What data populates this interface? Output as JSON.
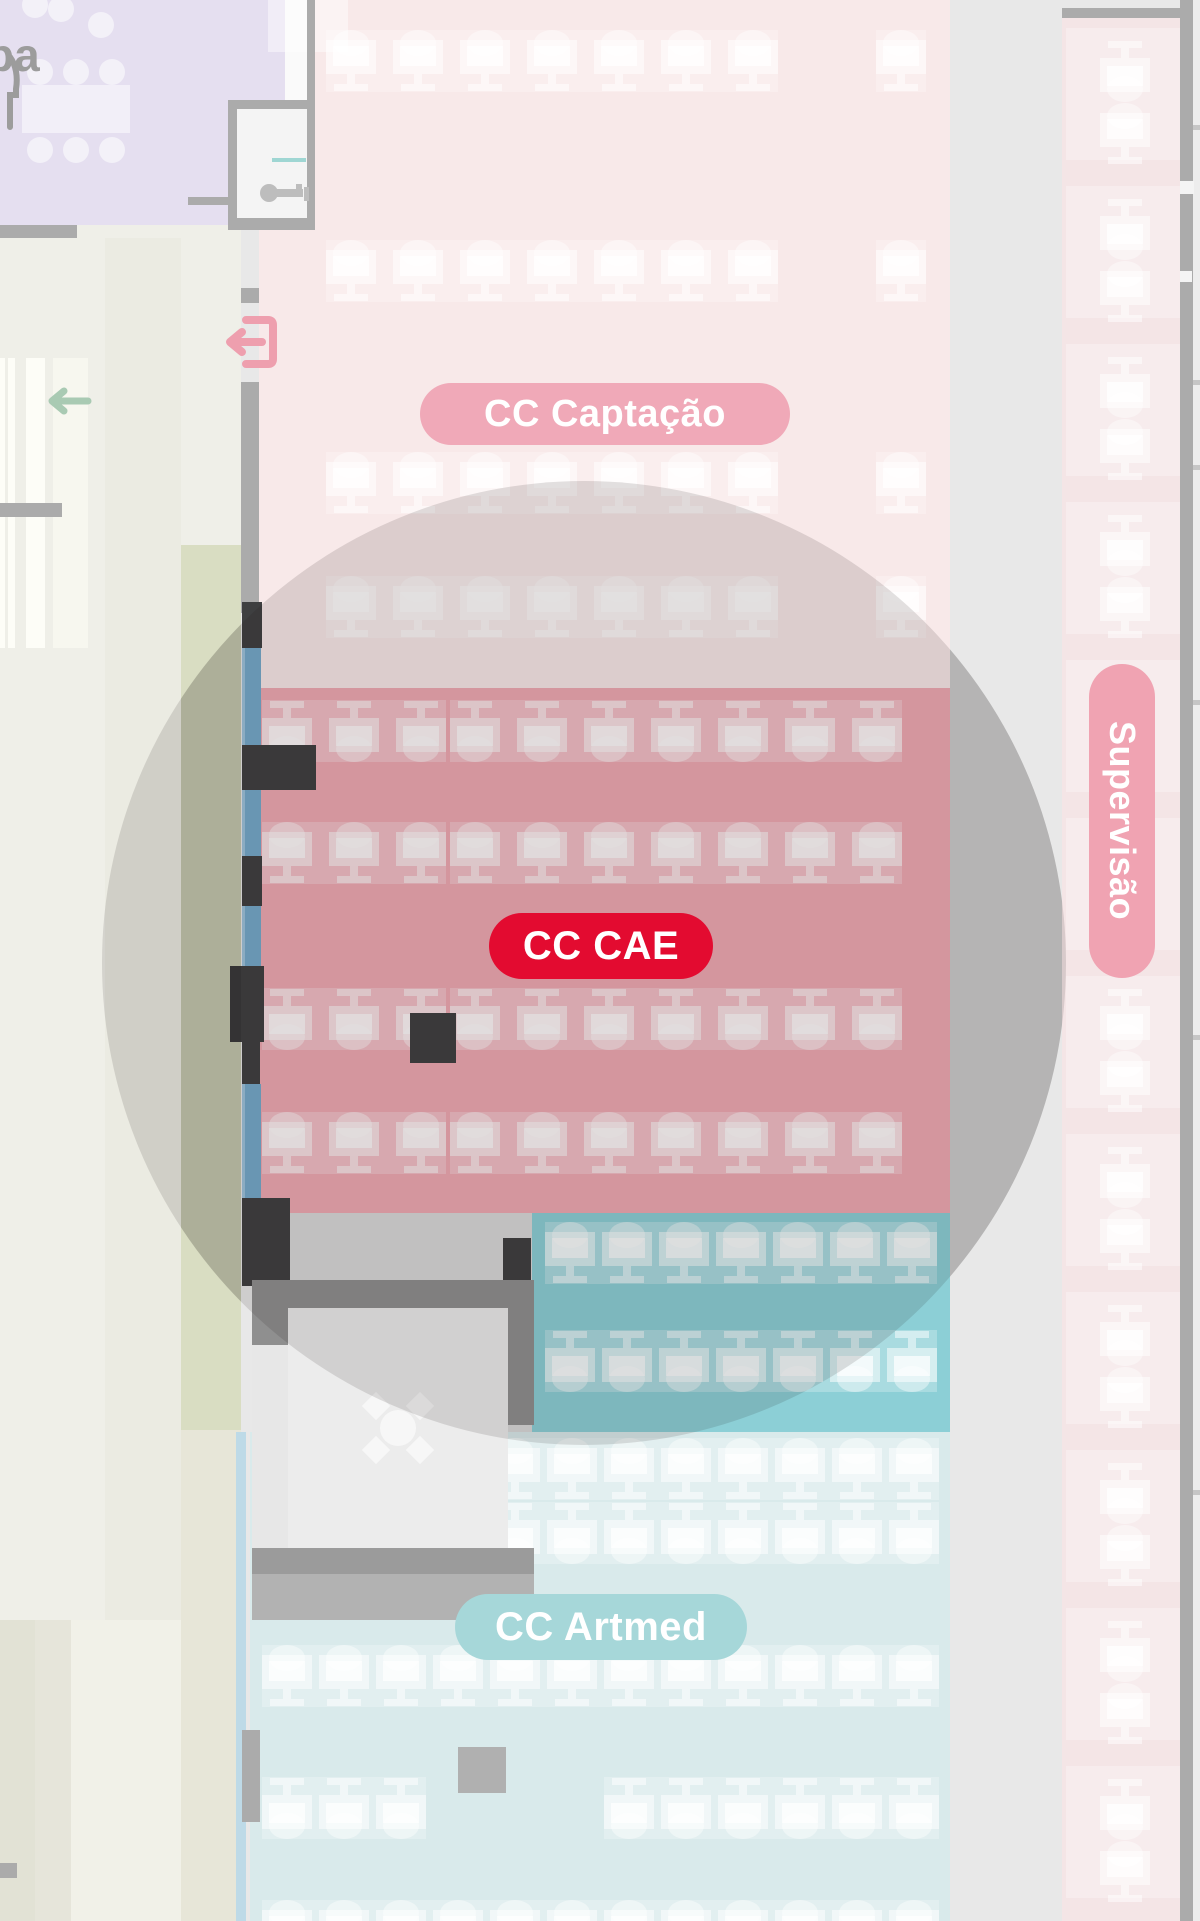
{
  "map_labels": {
    "copa_partial": "pa",
    "captacao": "CC Captação",
    "cae": "CC CAE",
    "supervisao": "Supervisão",
    "artmed": "CC Artmed"
  },
  "colors": {
    "pill_captacao_bg": "#f0a9b8",
    "pill_cae_bg": "#e30b30",
    "pill_supervisao_bg": "#f0a3b2",
    "pill_artmed_bg": "#a6d7d9",
    "pill_text": "#ffffff",
    "zone_captacao": "#f8e9e9",
    "zone_cae": "#efa9b3",
    "zone_teal": "#8ccfd6",
    "zone_artmed": "#d9eaeb",
    "zone_supervisao": "#f4e5e6",
    "zone_copa": "#e5dff0",
    "floor_base": "#e8e8e8",
    "floor_left": "#efefe8",
    "green_strip": "#d9ddc2",
    "khaki_strip": "#e7e6d8",
    "wall": "#ababab",
    "pillar_dark": "#3e3f40",
    "window_blue": "#74a9cb",
    "window_blue_light": "#bedae7",
    "exit_icon": "#ee9fae",
    "arrow_icon": "#a9cab3",
    "copa_text": "#9c9c9c"
  },
  "icons": [
    "exit-icon",
    "left-arrow-icon",
    "key-icon",
    "utensils-icon",
    "meeting-table-icon",
    "desk-icon"
  ],
  "desk_groups": [
    {
      "x": 326,
      "y": 30,
      "count": 7,
      "pitch": 67,
      "dir": "down",
      "band": true
    },
    {
      "x": 876,
      "y": 30,
      "count": 1,
      "pitch": 67,
      "dir": "down",
      "band": true
    },
    {
      "x": 326,
      "y": 240,
      "count": 7,
      "pitch": 67,
      "dir": "down",
      "band": true
    },
    {
      "x": 876,
      "y": 240,
      "count": 1,
      "pitch": 67,
      "dir": "down",
      "band": true
    },
    {
      "x": 326,
      "y": 452,
      "count": 7,
      "pitch": 67,
      "dir": "down",
      "band": true
    },
    {
      "x": 876,
      "y": 452,
      "count": 1,
      "pitch": 67,
      "dir": "down",
      "band": true
    },
    {
      "x": 326,
      "y": 576,
      "count": 7,
      "pitch": 67,
      "dir": "down",
      "band": true
    },
    {
      "x": 876,
      "y": 576,
      "count": 1,
      "pitch": 67,
      "dir": "down",
      "band": true
    },
    {
      "x": 262,
      "y": 700,
      "count": 3,
      "pitch": 67,
      "dir": "up",
      "band": true
    },
    {
      "x": 450,
      "y": 700,
      "count": 7,
      "pitch": 67,
      "dir": "up",
      "band": true
    },
    {
      "x": 262,
      "y": 822,
      "count": 3,
      "pitch": 67,
      "dir": "down",
      "band": true
    },
    {
      "x": 450,
      "y": 822,
      "count": 7,
      "pitch": 67,
      "dir": "down",
      "band": true
    },
    {
      "x": 262,
      "y": 988,
      "count": 3,
      "pitch": 67,
      "dir": "up",
      "band": true
    },
    {
      "x": 450,
      "y": 988,
      "count": 7,
      "pitch": 67,
      "dir": "up",
      "band": true
    },
    {
      "x": 262,
      "y": 1112,
      "count": 3,
      "pitch": 67,
      "dir": "down",
      "band": true
    },
    {
      "x": 450,
      "y": 1112,
      "count": 7,
      "pitch": 67,
      "dir": "down",
      "band": true
    },
    {
      "x": 545,
      "y": 1222,
      "count": 7,
      "pitch": 57,
      "dir": "down",
      "band": true
    },
    {
      "x": 545,
      "y": 1330,
      "count": 7,
      "pitch": 57,
      "dir": "up",
      "band": true
    },
    {
      "x": 262,
      "y": 1438,
      "count": 12,
      "pitch": 57,
      "dir": "down",
      "band": true
    },
    {
      "x": 262,
      "y": 1502,
      "count": 12,
      "pitch": 57,
      "dir": "up",
      "band": true
    },
    {
      "x": 262,
      "y": 1645,
      "count": 12,
      "pitch": 57,
      "dir": "down",
      "band": true
    },
    {
      "x": 262,
      "y": 1777,
      "count": 3,
      "pitch": 57,
      "dir": "up",
      "band": true
    },
    {
      "x": 604,
      "y": 1777,
      "count": 6,
      "pitch": 57,
      "dir": "up",
      "band": true
    },
    {
      "x": 262,
      "y": 1900,
      "count": 12,
      "pitch": 57,
      "dir": "down",
      "band": true
    },
    {
      "x": 1100,
      "y": 40,
      "count": 12,
      "pitch": 158,
      "dir": "up",
      "vertical": true
    },
    {
      "x": 1100,
      "y": 103,
      "count": 12,
      "pitch": 158,
      "dir": "down",
      "vertical": true
    }
  ]
}
